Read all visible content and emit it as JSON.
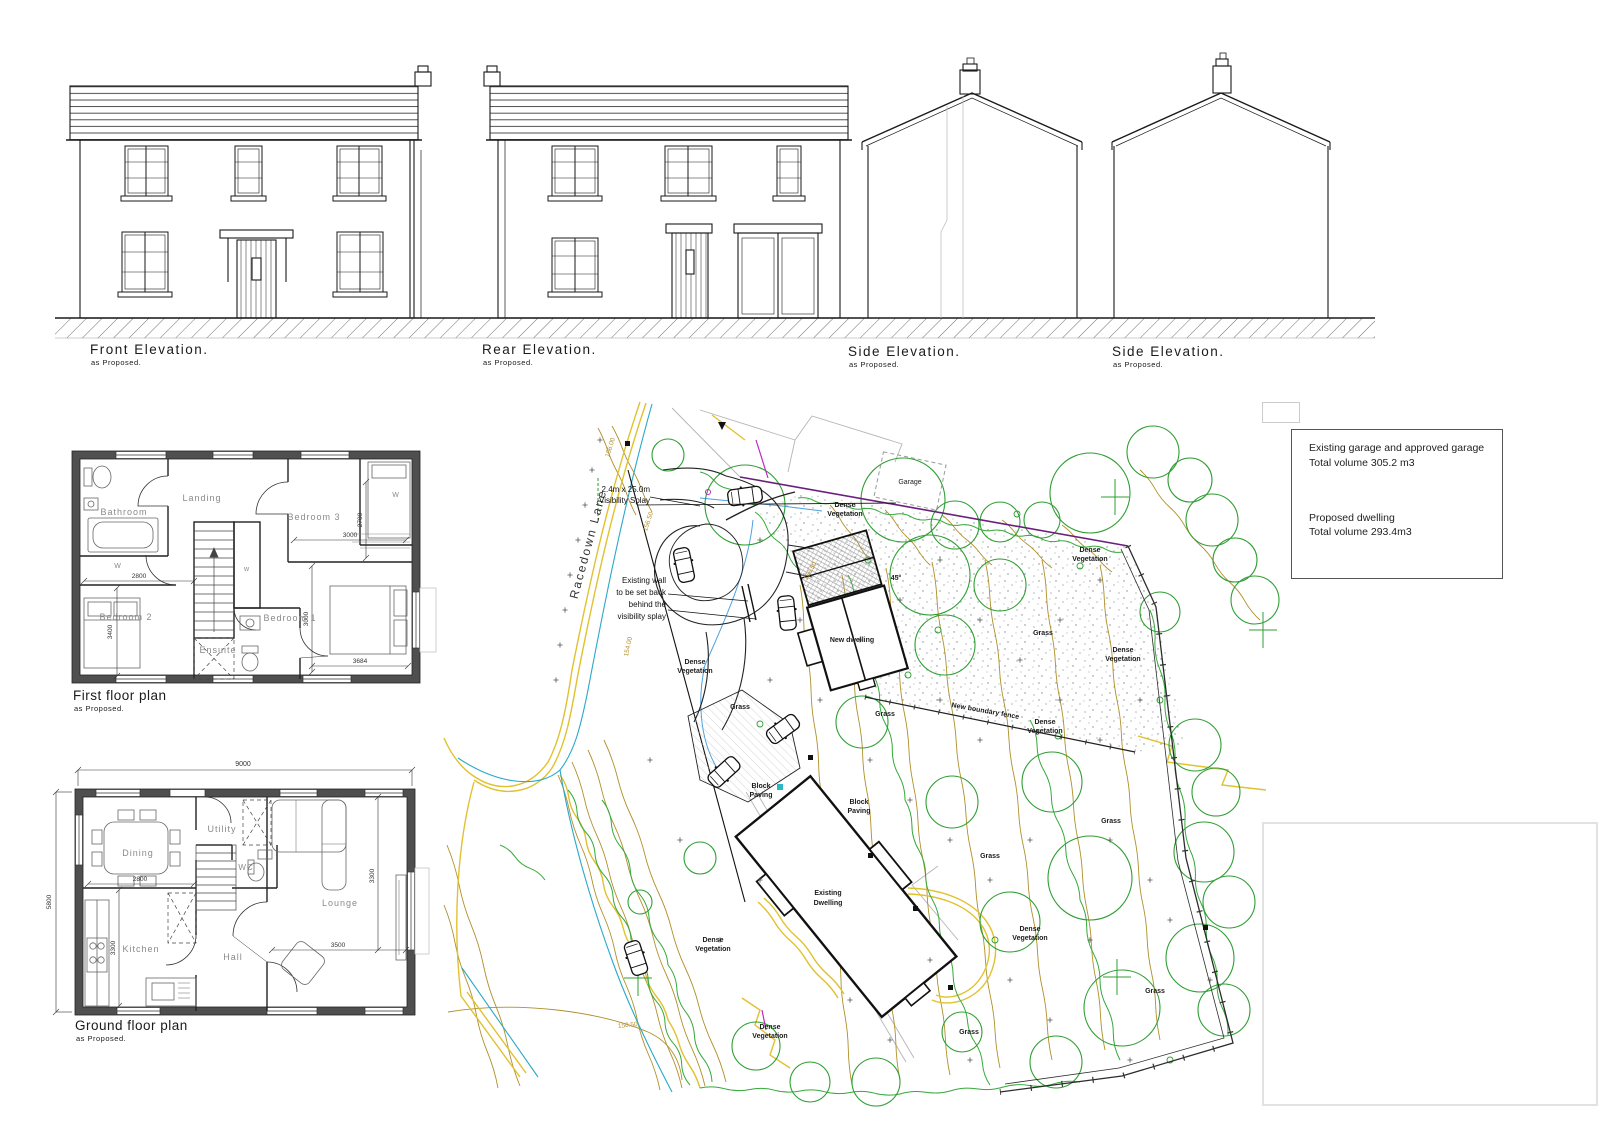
{
  "titles": {
    "front": {
      "title": "Front  Elevation.",
      "subtitle": "as  Proposed."
    },
    "rear": {
      "title": "Rear  Elevation.",
      "subtitle": "as  Proposed."
    },
    "side1": {
      "title": "Side  Elevation.",
      "subtitle": "as  Proposed."
    },
    "side2": {
      "title": "Side  Elevation.",
      "subtitle": "as  Proposed."
    },
    "first_floor": {
      "title": "First floor plan",
      "subtitle": "as  Proposed."
    },
    "ground_floor": {
      "title": "Ground floor plan",
      "subtitle": "as  Proposed."
    }
  },
  "first_floor": {
    "rooms": {
      "bathroom": "Bathroom",
      "landing": "Landing",
      "bedroom3": "Bedroom 3",
      "bedroom2": "Bedroom 2",
      "bedroom1": "Bedroom 1",
      "ensuite": "Ensuite"
    },
    "wardrobe": "W",
    "wardrobe_small": "w",
    "dims": {
      "bedroom2_w": "2800",
      "bedroom2_d": "3400",
      "bedroom3_w": "3000",
      "bedroom3_d": "2700",
      "bedroom1_d": "3000",
      "bedroom1_w": "3684"
    }
  },
  "ground_floor": {
    "rooms": {
      "dining": "Dining",
      "utility": "Utility",
      "kitchen": "Kitchen",
      "hall": "Hall",
      "wc": "WC",
      "lounge": "Lounge"
    },
    "dims": {
      "overall_w": "9000",
      "overall_d": "5800",
      "kitchen_w": "2800",
      "kitchen_d": "3300",
      "lounge_w": "3500",
      "lounge_d": "3300"
    }
  },
  "site_plan": {
    "road_name": "Racedown Lane",
    "labels": {
      "garage": "Garage",
      "new_dwelling": "New dwelling",
      "existing_dwelling_1": "Existing",
      "existing_dwelling_2": "Dwelling",
      "dense_1": "Dense",
      "dense_2": "Vegetation",
      "grass": "Grass",
      "block_1": "Block",
      "block_2": "Paving",
      "boundary_fence": "New boundary fence",
      "angle": "45°"
    },
    "contours": {
      "c156": "156.00",
      "c156_5": "156.50",
      "c154": "154.00",
      "c150_5": "150.50"
    },
    "annotations": {
      "splay_1": "2.4m x 25.0m",
      "splay_2": "Visibility Splay",
      "wall_1": "Existing wall",
      "wall_2": "to be set back",
      "wall_3": "behind the",
      "wall_4": "visibility splay"
    }
  },
  "notes_box": {
    "line1": "Existing garage and approved garage",
    "line2": "Total volume  305.2 m3",
    "line3": "Proposed dwelling",
    "line4": "Total volume 293.4m3"
  }
}
